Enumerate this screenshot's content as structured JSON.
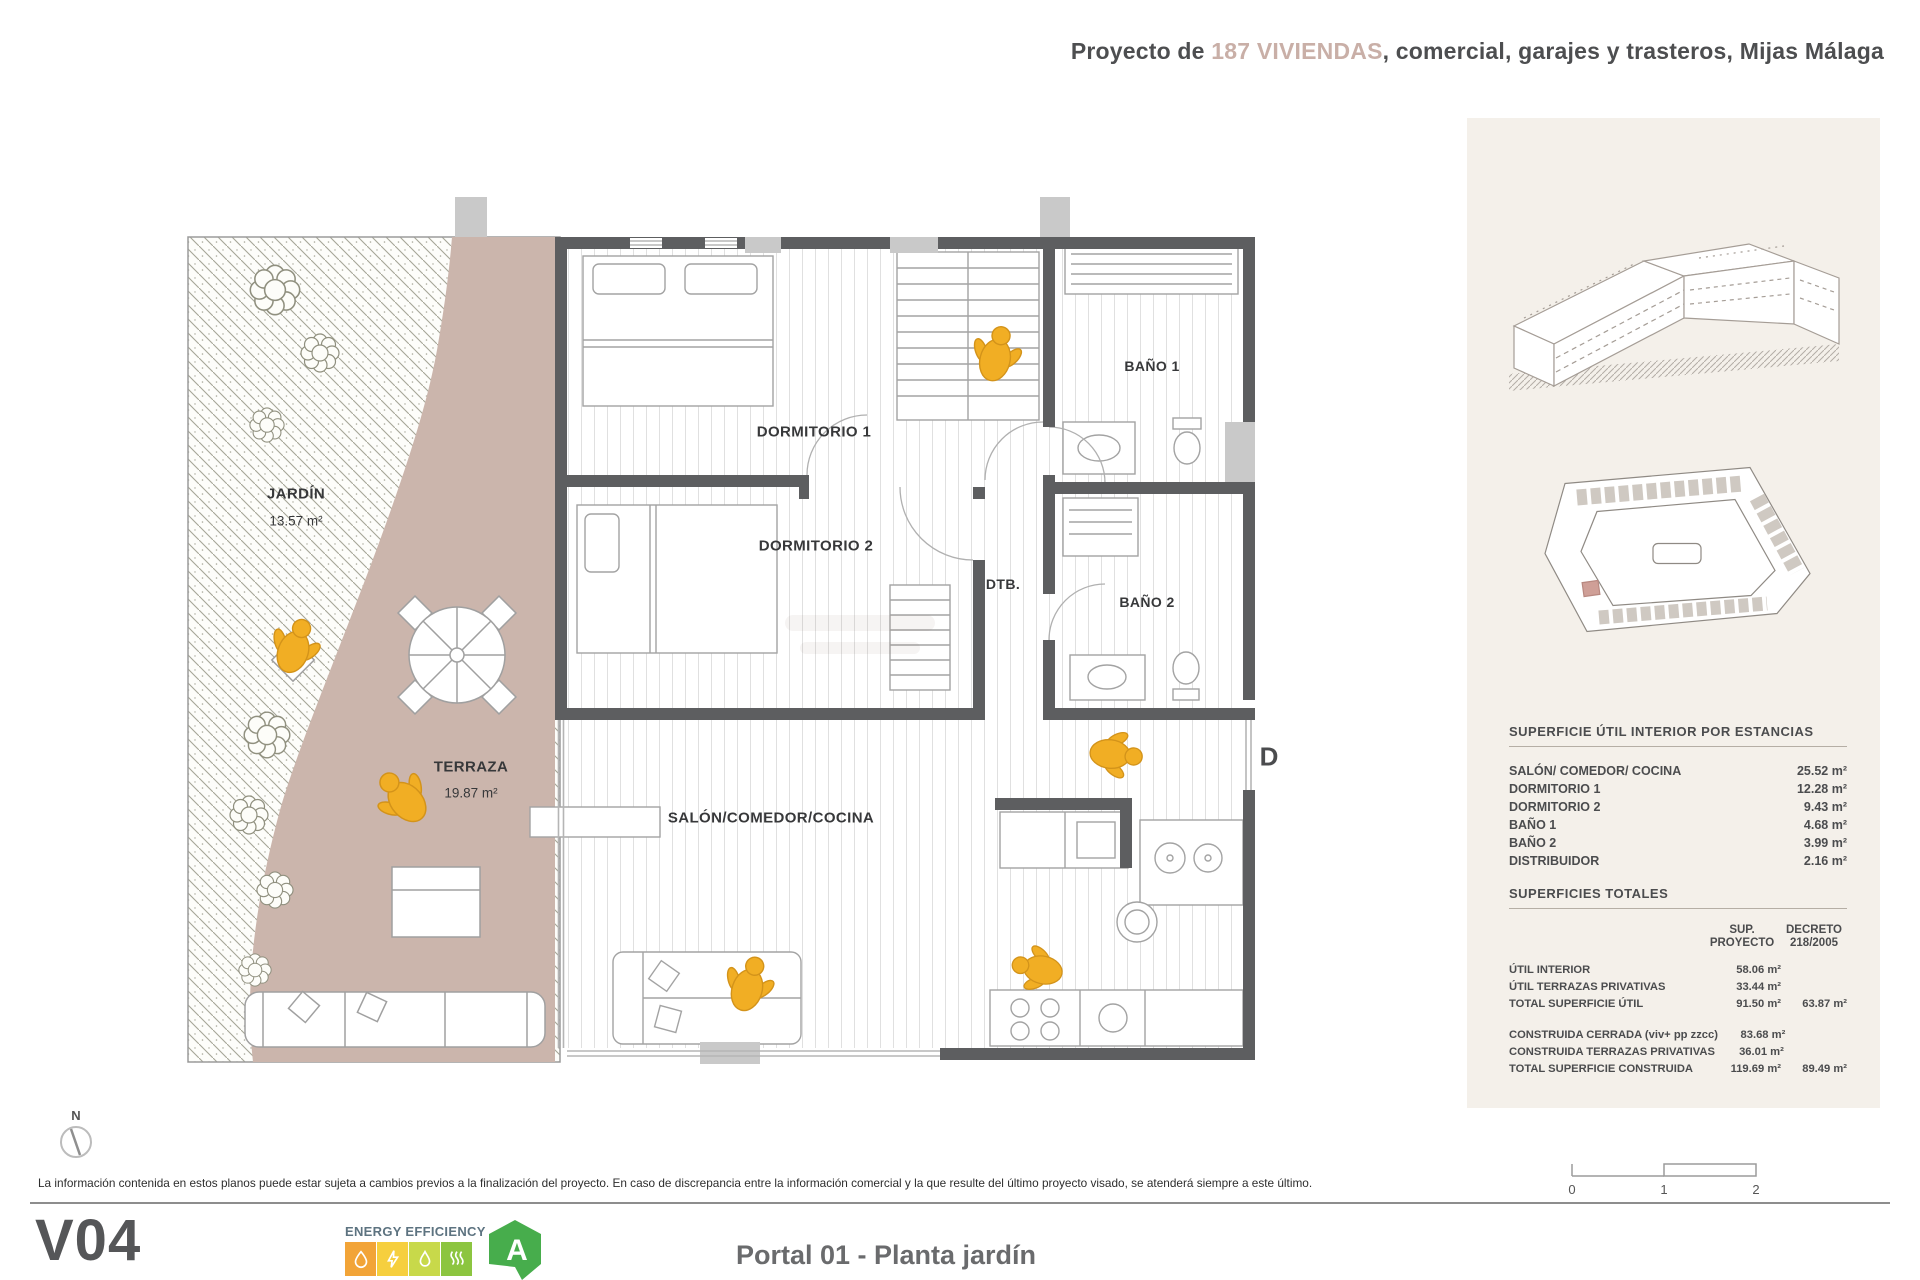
{
  "header": {
    "title_prefix": "Proyecto de ",
    "title_highlight": "187 VIVIENDAS",
    "title_suffix": ", comercial, garajes y trasteros, Mijas Málaga"
  },
  "plan": {
    "jardin": {
      "name": "JARDÍN",
      "area": "13.57 m²"
    },
    "terraza": {
      "name": "TERRAZA",
      "area": "19.87 m²"
    },
    "dormitorio1": "DORMITORIO 1",
    "dormitorio2": "DORMITORIO 2",
    "salon": "SALÓN/COMEDOR/COCINA",
    "dtb": "DTB.",
    "bano1": "BAÑO 1",
    "bano2": "BAÑO 2",
    "section_marker": "D",
    "compass": "N"
  },
  "sidebar": {
    "table_estancias": {
      "title": "SUPERFICIE ÚTIL INTERIOR POR ESTANCIAS",
      "rows": [
        {
          "label": "SALÓN/ COMEDOR/ COCINA",
          "value": "25.52 m²"
        },
        {
          "label": "DORMITORIO 1",
          "value": "12.28 m²"
        },
        {
          "label": "DORMITORIO 2",
          "value": "9.43 m²"
        },
        {
          "label": "BAÑO 1",
          "value": "4.68 m²"
        },
        {
          "label": "BAÑO 2",
          "value": "3.99 m²"
        },
        {
          "label": "DISTRIBUIDOR",
          "value": "2.16 m²"
        }
      ]
    },
    "table_totales": {
      "title": "SUPERFICIES TOTALES",
      "col1": "SUP. PROYECTO",
      "col2": "DECRETO 218/2005",
      "rows": [
        {
          "label": "ÚTIL INTERIOR",
          "v1": "58.06 m²",
          "v2": ""
        },
        {
          "label": "ÚTIL TERRAZAS PRIVATIVAS",
          "v1": "33.44 m²",
          "v2": ""
        },
        {
          "label": "TOTAL SUPERFICIE ÚTIL",
          "v1": "91.50 m²",
          "v2": "63.87 m²"
        },
        {
          "label": "CONSTRUIDA CERRADA (viv+ pp zzcc)",
          "v1": "83.68 m²",
          "v2": ""
        },
        {
          "label": "CONSTRUIDA TERRAZAS PRIVATIVAS",
          "v1": "36.01 m²",
          "v2": ""
        },
        {
          "label": "TOTAL SUPERFICIE CONSTRUIDA",
          "v1": "119.69 m²",
          "v2": "89.49 m²"
        }
      ]
    }
  },
  "footer": {
    "disclaimer": "La información contenida en estos planos puede estar sujeta a cambios previos a la finalización del proyecto. En caso de discrepancia entre la información comercial y la que resulte del último proyecto visado, se atenderá siempre a este último.",
    "version": "V04",
    "energy_label": "ENERGY EFFICIENCY",
    "energy_rating": "A",
    "plan_title": "Portal 01 - Planta jardín",
    "scale": {
      "t0": "0",
      "t1": "1",
      "t2": "2"
    }
  }
}
